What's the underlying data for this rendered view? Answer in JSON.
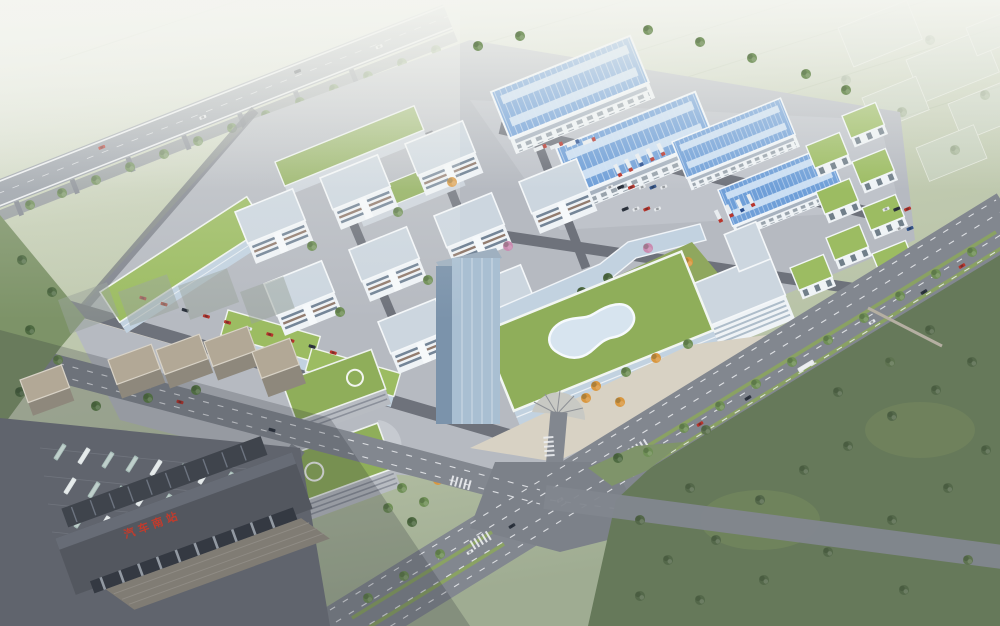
{
  "station": {
    "sign": "汽车南站"
  },
  "palette": {
    "haze": "#eef1ea",
    "field": "#c6cfb6",
    "field2": "#b7c2a6",
    "ground": "#b6bac1",
    "ground2": "#c3c7cd",
    "groundDark": "#60646d",
    "road": "#82878f",
    "roadDark": "#6e727b",
    "marking": "#eceef1",
    "median": "#8aa263",
    "pavedTan": "#d8d2c4",
    "factoryRoof": "#6f9fd8",
    "factorySky": "#cfe2f4",
    "wallWhite": "#eff3f6",
    "wallShade": "#cdd4dc",
    "windowBand": "#5f7287",
    "officeRoof": "#ccd6df",
    "greenRoof": "#8fae5a",
    "greenRoofBright": "#9cbc62",
    "glass": "#c2d2e0",
    "glassDark": "#51616f",
    "towerGlass": "#a9bfd2",
    "treeDark": "#4f6b42",
    "treeMid": "#6f8f56",
    "autumn": "#d9973f",
    "pinkTree": "#c98bb0",
    "forest": "#66795a",
    "forestDark": "#54684a",
    "residWall": "#c9c0b2",
    "residRoof": "#b2a896",
    "busTeal": "#a7bdb8",
    "busWhite": "#dde3e4",
    "stationRoof": "#53575f",
    "signRed": "#c23b2c",
    "ghost": "#ccd6c8",
    "carRed": "#b8352c",
    "carWhite": "#e6e9ec",
    "carDark": "#2e3540"
  }
}
